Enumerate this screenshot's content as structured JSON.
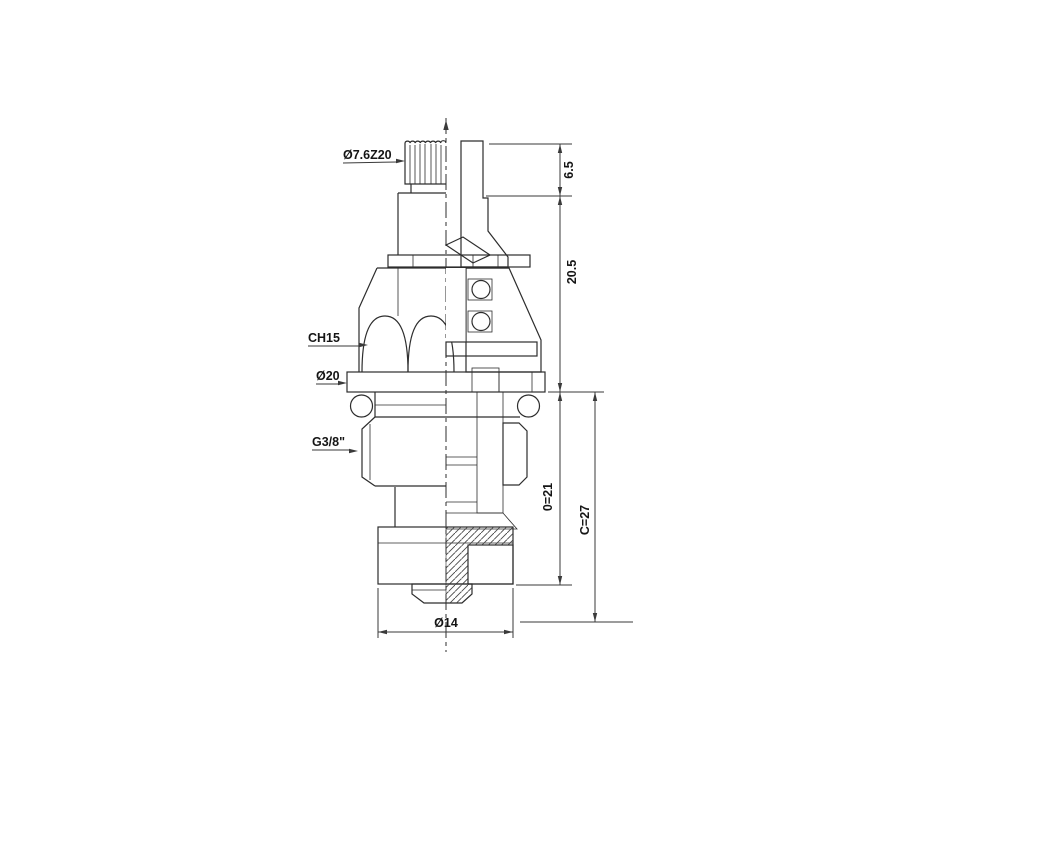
{
  "drawing": {
    "callouts": {
      "spline_top": "Ø7.6Z20",
      "hex": "CH15",
      "flange_diameter": "Ø20",
      "thread": "G3/8\"",
      "base_diameter": "Ø14"
    },
    "dimensions": {
      "top_height": "6.5",
      "upper_height": "20.5",
      "o_length": "0=21",
      "c_length": "C=27"
    }
  }
}
